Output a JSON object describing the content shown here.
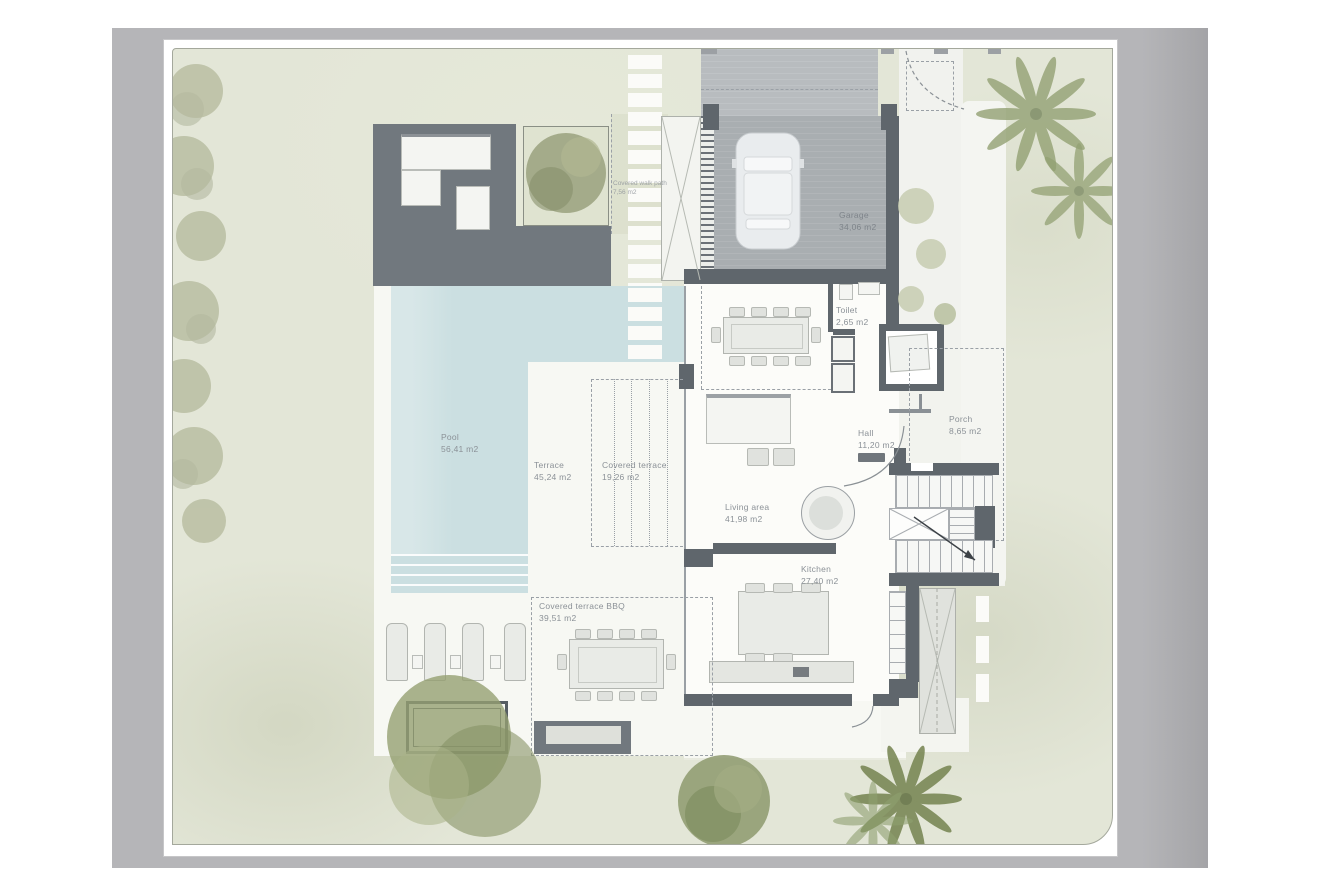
{
  "colors": {
    "canvas": "#b5b5b8",
    "page": "#ffffff",
    "plan_bg": "#e3e6d7",
    "terrace": "#f7f8f3",
    "house_floor": "#fcfcf9",
    "wall": "#5f666c",
    "deck": "#71787e",
    "pool_water": "#cbdfe1",
    "garage_floor": "#a9aeb1",
    "driveway": "#b8bcbf",
    "furniture_fill": "#e9ebe7",
    "furniture_line": "#b2b5b0",
    "label_text": "#8b9197",
    "dash_line": "#9aa0a6",
    "tree_green": "#96a075",
    "tree_muted": "#b7bc9f",
    "palm_green": "#8fa070",
    "bush_green": "#c7cdb0"
  },
  "rooms": {
    "pool": {
      "label": "Pool",
      "area": "56,41 m2"
    },
    "terrace": {
      "label": "Terrace",
      "area": "45,24 m2"
    },
    "covered_terrace": {
      "label": "Covered terrace",
      "area": "19,26 m2"
    },
    "covered_walk_path": {
      "label": "Covered walk path",
      "area": "7,56 m2"
    },
    "garage": {
      "label": "Garage",
      "area": "34,06 m2"
    },
    "toilet": {
      "label": "Toilet",
      "area": "2,65 m2"
    },
    "hall": {
      "label": "Hall",
      "area": "11,20 m2"
    },
    "porch": {
      "label": "Porch",
      "area": "8,65 m2"
    },
    "living_area": {
      "label": "Living area",
      "area": "41,98 m2"
    },
    "kitchen": {
      "label": "Kitchen",
      "area": "27,40 m2"
    },
    "covered_terrace_bbq": {
      "label": "Covered terrace BBQ",
      "area": "39,51 m2"
    }
  }
}
